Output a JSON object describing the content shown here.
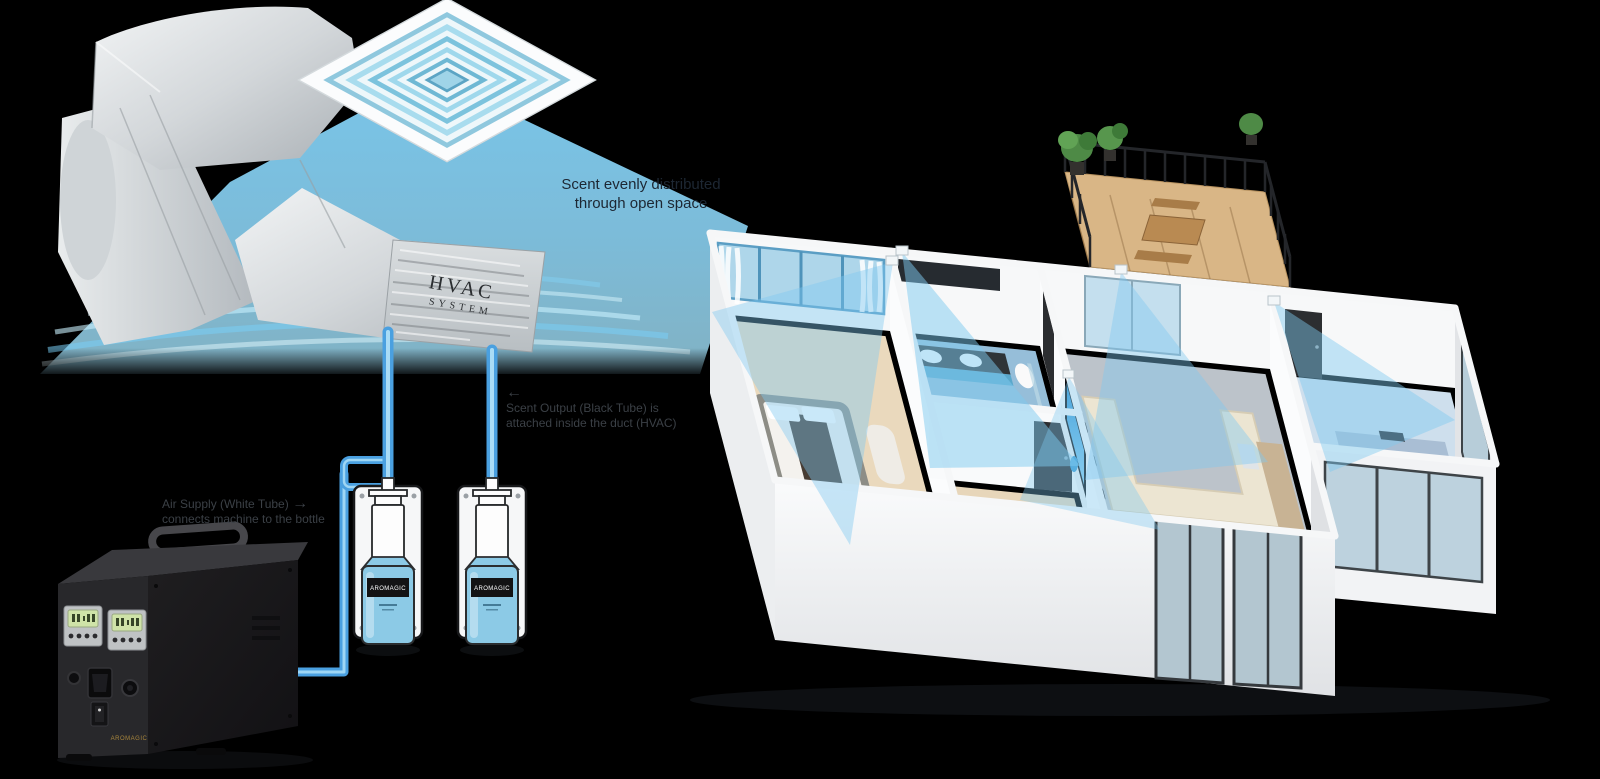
{
  "hvac": {
    "title_line1": "HVAC",
    "title_line2": "SYSTEM"
  },
  "labels": {
    "distribution_line1": "Scent evenly distributed",
    "distribution_line2": "through open space",
    "scent_output_arrow": "←",
    "scent_output_line1": "Scent Output (Black Tube) is",
    "scent_output_line2": "attached inside the duct (HVAC)",
    "air_supply_line1": "Air Supply (White Tube)",
    "air_supply_arrow": "→",
    "air_supply_line2": "connects machine to the bottle"
  },
  "bottle": {
    "brand": "AROMAGIC"
  },
  "machine": {
    "brand": "AROMAGIC"
  },
  "colors": {
    "mist": "#7fcdf0",
    "tube": "#4aa0e0",
    "background": "#000000"
  }
}
